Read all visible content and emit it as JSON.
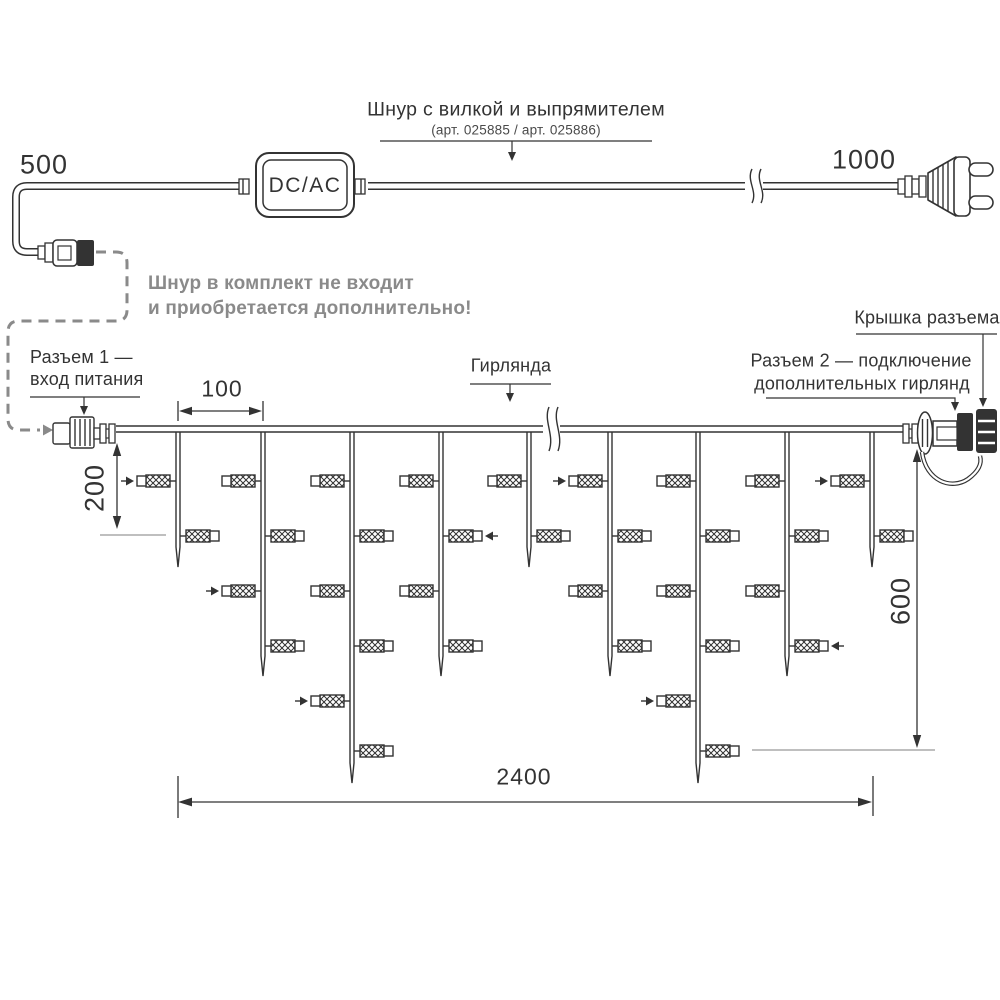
{
  "title_callout": {
    "line1": "Шнур с вилкой и выпрямителем",
    "line2": "(арт. 025885 / арт. 025886)"
  },
  "converter": {
    "label": "DC/AC"
  },
  "note": {
    "line1": "Шнур в комплект не входит",
    "line2": "и приобретается дополнительно!"
  },
  "callouts": {
    "connector1_line1": "Разъем 1 —",
    "connector1_line2": "вход питания",
    "garland": "Гирлянда",
    "connector_cap": "Крышка разъема",
    "connector2_line1": "Разъем 2 — подключение",
    "connector2_line2": "дополнительных гирлянд"
  },
  "dimensions": {
    "cord_left": "500",
    "cord_right": "1000",
    "drop_spacing": "100",
    "first_drop_height": "200",
    "curtain_height": "600",
    "curtain_width": "2400"
  },
  "colors": {
    "ink": "#333333",
    "gray": "#8a8a8a",
    "ref_line": "#999999",
    "background": "#ffffff"
  },
  "garland": {
    "wire_y": 429,
    "lamp_rows_y": [
      481,
      536,
      591,
      646,
      701,
      751
    ],
    "drops": [
      {
        "x": 178,
        "tip_y": 567,
        "lamps": [
          {
            "row": 0,
            "side": "L",
            "arrow": true
          },
          {
            "row": 1,
            "side": "R"
          }
        ]
      },
      {
        "x": 263,
        "tip_y": 676,
        "lamps": [
          {
            "row": 0,
            "side": "L"
          },
          {
            "row": 1,
            "side": "R"
          },
          {
            "row": 2,
            "side": "L",
            "arrow": true
          },
          {
            "row": 3,
            "side": "R"
          }
        ]
      },
      {
        "x": 352,
        "tip_y": 783,
        "lamps": [
          {
            "row": 0,
            "side": "L"
          },
          {
            "row": 1,
            "side": "R"
          },
          {
            "row": 2,
            "side": "L"
          },
          {
            "row": 3,
            "side": "R"
          },
          {
            "row": 4,
            "side": "L",
            "arrow": true
          },
          {
            "row": 5,
            "side": "R"
          }
        ]
      },
      {
        "x": 441,
        "tip_y": 676,
        "lamps": [
          {
            "row": 0,
            "side": "L"
          },
          {
            "row": 1,
            "side": "R",
            "arrow": true
          },
          {
            "row": 2,
            "side": "L"
          },
          {
            "row": 3,
            "side": "R"
          }
        ]
      },
      {
        "x": 529,
        "tip_y": 567,
        "lamps": [
          {
            "row": 0,
            "side": "L"
          },
          {
            "row": 1,
            "side": "R"
          }
        ]
      },
      {
        "x": 610,
        "tip_y": 676,
        "lamps": [
          {
            "row": 0,
            "side": "L",
            "arrow": true
          },
          {
            "row": 1,
            "side": "R"
          },
          {
            "row": 2,
            "side": "L"
          },
          {
            "row": 3,
            "side": "R"
          }
        ]
      },
      {
        "x": 698,
        "tip_y": 783,
        "lamps": [
          {
            "row": 0,
            "side": "L"
          },
          {
            "row": 1,
            "side": "R"
          },
          {
            "row": 2,
            "side": "L"
          },
          {
            "row": 3,
            "side": "R"
          },
          {
            "row": 4,
            "side": "L",
            "arrow": true
          },
          {
            "row": 5,
            "side": "R"
          }
        ]
      },
      {
        "x": 787,
        "tip_y": 676,
        "lamps": [
          {
            "row": 0,
            "side": "L"
          },
          {
            "row": 1,
            "side": "R"
          },
          {
            "row": 2,
            "side": "L"
          },
          {
            "row": 3,
            "side": "R",
            "arrow": true
          }
        ]
      },
      {
        "x": 872,
        "tip_y": 567,
        "lamps": [
          {
            "row": 0,
            "side": "L",
            "arrow": true
          },
          {
            "row": 1,
            "side": "R"
          }
        ]
      }
    ]
  }
}
